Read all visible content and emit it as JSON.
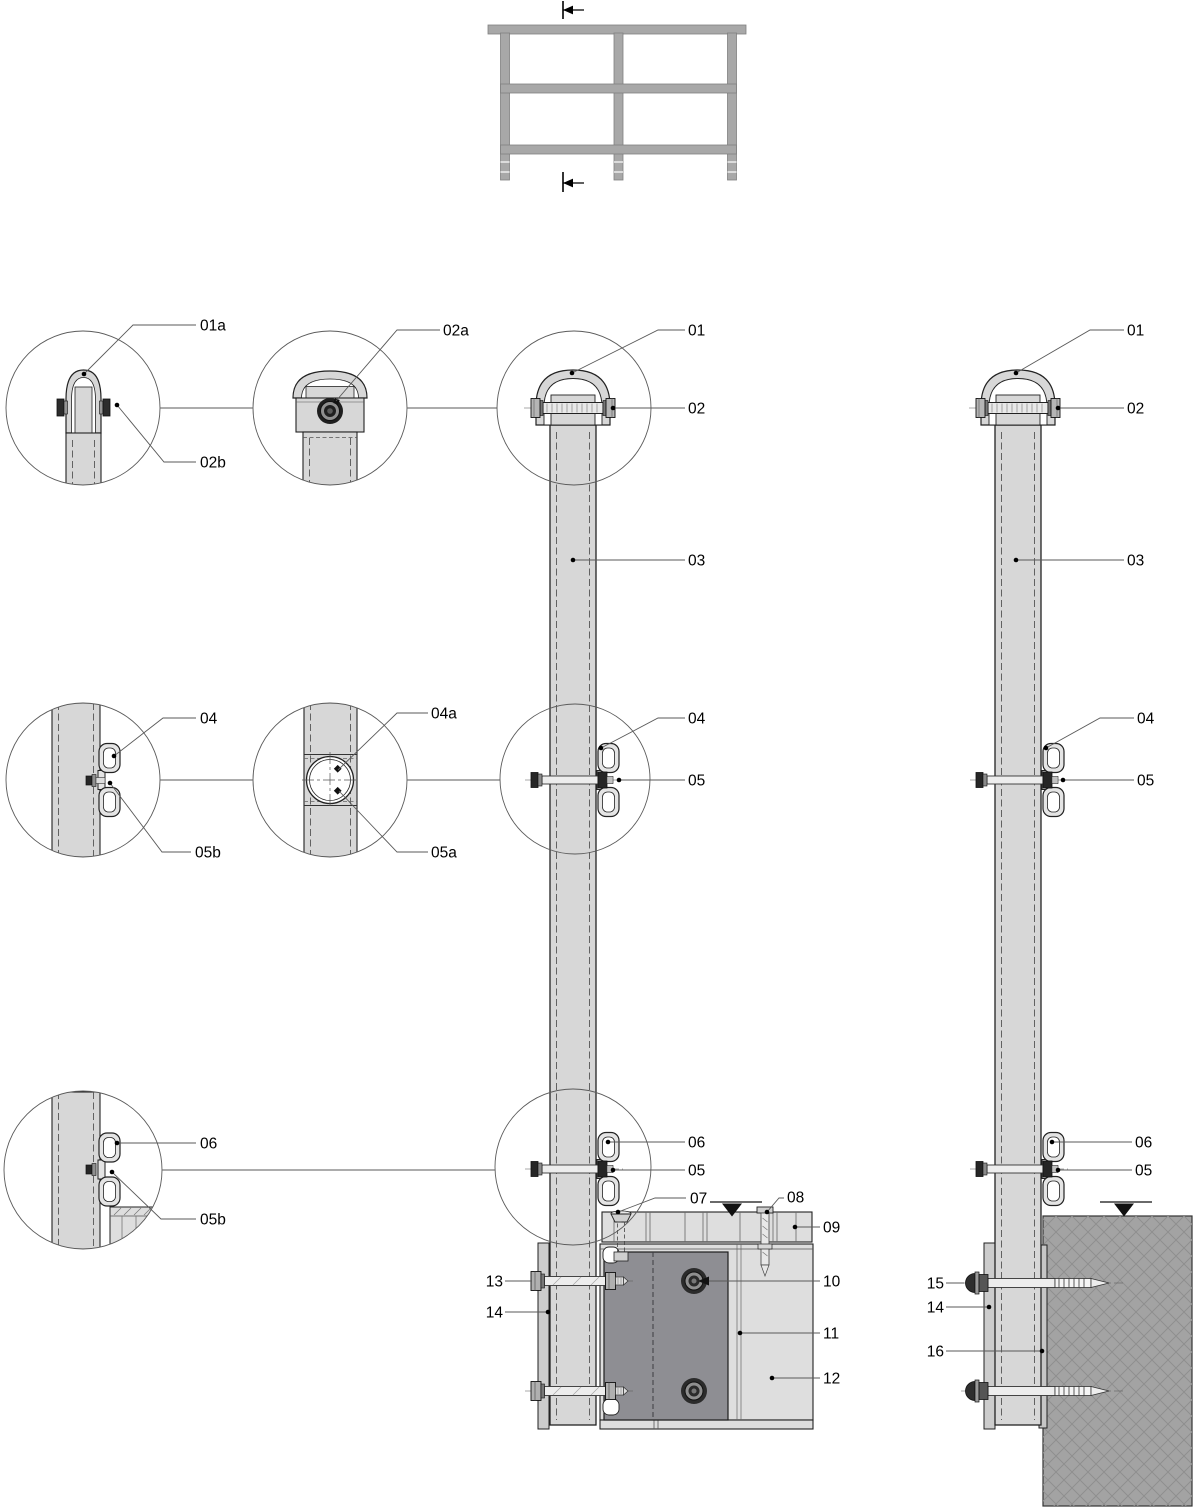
{
  "callouts": {
    "01": "01",
    "01a": "01a",
    "02": "02",
    "02a": "02a",
    "02b": "02b",
    "03": "03",
    "04": "04",
    "04a": "04a",
    "05": "05",
    "05a": "05a",
    "05b": "05b",
    "06": "06",
    "07": "07",
    "08": "08",
    "09": "09",
    "10": "10",
    "11": "11",
    "12": "12",
    "13": "13",
    "14": "14",
    "15": "15",
    "16": "16"
  },
  "colors": {
    "line": "#222222",
    "post": "#d7d7d7",
    "rail": "#a8a8a8",
    "deck": "#dedede",
    "plate": "#8e8e93",
    "concrete": "#a3a3a3",
    "bar": "#cccccc",
    "bracket": "#e4e4e4",
    "spacer": "#c6c6c6"
  }
}
